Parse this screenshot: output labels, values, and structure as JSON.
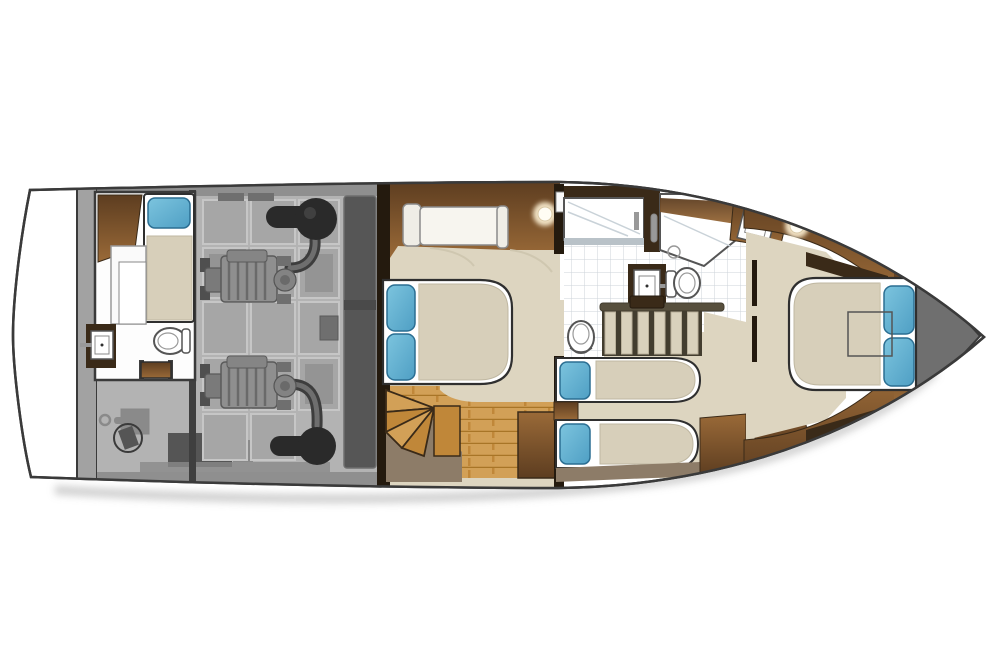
{
  "scene": {
    "type": "yacht-lower-deck-floorplan",
    "view": "top-down",
    "orientation": "bow-right"
  },
  "regions": [
    {
      "id": "swim-platform",
      "furniture": []
    },
    {
      "id": "crew-cabin",
      "furniture": [
        "single-berth",
        "blue-pillow",
        "wardrobe",
        "seat",
        "sink",
        "toilet",
        "entry-step"
      ]
    },
    {
      "id": "engine-room",
      "furniture": [
        "engine",
        "engine",
        "exhaust-muffler",
        "exhaust-muffler",
        "fuel-tank",
        "seacock-valve",
        "equipment-boxes",
        "floor-hatches"
      ]
    },
    {
      "id": "master-stateroom",
      "furniture": [
        "double-bed",
        "blue-pillow",
        "blue-pillow",
        "sofa",
        "ceiling-light",
        "wood-floor",
        "winder-stairs",
        "cabinet"
      ]
    },
    {
      "id": "midship-head",
      "furniture": [
        "bathtub",
        "shower-stall",
        "sink-vanity",
        "toilet",
        "tile-floor"
      ]
    },
    {
      "id": "companionway-stairs",
      "furniture": [
        "six-steps",
        "handrail"
      ]
    },
    {
      "id": "guest-cabin",
      "furniture": [
        "twin-berth",
        "twin-berth",
        "blue-pillow",
        "blue-pillow",
        "nightstand"
      ]
    },
    {
      "id": "forward-head",
      "furniture": [
        "sink-vanity",
        "ceiling-light",
        "tile-floor"
      ]
    },
    {
      "id": "forward-stateroom",
      "furniture": [
        "island-bed",
        "blue-pillow",
        "blue-pillow",
        "overhead-hatch-outline",
        "cabinets"
      ]
    },
    {
      "id": "bow-anchor-locker",
      "furniture": []
    }
  ],
  "colors": {
    "hull_fill": "#ffffff",
    "hull_stroke": "#3a3a3a",
    "transom": "#a2a2a2",
    "gunwale": "#8f8f8f",
    "engine_floor": "#b3b3b3",
    "engine_panel": "#a6a6a6",
    "engine_panel_edge": "#c6c6c6",
    "engine_panel_inner": "#949494",
    "engine_wall": "#3f3f3f",
    "tank": "#565656",
    "tank_band": "#4a4a4a",
    "muffler": "#2a2a2a",
    "muffler_hl": "#4a4a4a",
    "pipe_dark": "#3d3d3d",
    "pipe_light": "#6e6e6e",
    "engine_body": "#8f8f8f",
    "engine_block_edge": "#5a5a5a",
    "engine_detail": "#6a6a6a",
    "engine_gear": "#7a7a7a",
    "engine_head": "#858585",
    "engine_turbo": "#838383",
    "engine_small": "#6f6f6f",
    "engine_mount": "#4f4f4f",
    "equipment": "#555555",
    "equipment_light": "#8a8a8a",
    "valve_ring": "#3a3a3a",
    "room_white": "#fdfdfd",
    "fixture_white": "#ffffff",
    "fixture_stroke": "#555555",
    "gray_mid": "#888888",
    "toilet_inner": "#999999",
    "carpet": "#ddd5c0",
    "carpet_shade": "#cfc7b0",
    "duvet": "#d7cfba",
    "duvet_edge": "#bfb7a1",
    "pillow_light": "#7cc4de",
    "pillow_mid": "#4f9fc4",
    "pillow_stroke": "#2b6e92",
    "brown_light": "#9a6a38",
    "brown_dark": "#5d3d20",
    "wall_brown": "#3a2a18",
    "wall_dark": "#241a0e",
    "wood_light": "#d2a057",
    "wood_mid": "#c08739",
    "wood_seam": "#a87527",
    "taupe": "#8d7c68",
    "tile_line": "#ccd3da",
    "tub_rim": "#b9c2c8",
    "glass_line": "#c9d2d8",
    "stair_base": "#433d2f",
    "stair_tread": "#d9d1bc",
    "stair_tread_edge": "#b9b09a",
    "rail": "#574f3d",
    "locker": "#6f6f6f",
    "light_glow": "#fff3d6",
    "light_core": "#fffdf4",
    "light_ring": "#d9c9a6",
    "chrome": "#999999",
    "shadow": "#a8a8a8",
    "sofa_white": "#f7f5ef",
    "sofa_arm": "#efede6",
    "sofa_edge": "#8a8a8a",
    "seat_white": "#fafafa",
    "frame_stroke": "#2f2f2f"
  }
}
